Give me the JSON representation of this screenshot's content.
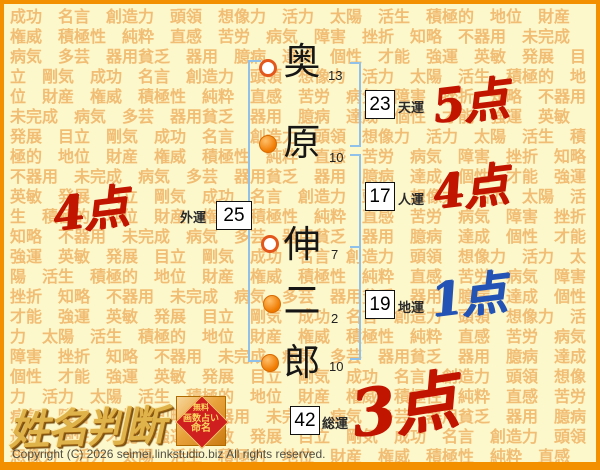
{
  "background": {
    "word_cycle": "成功　名言　創造力　頭領　想像力　活力　太陽　活生　積極的　地位　財産　権威　積極性　純粋　直感　苦労　病気　障害　挫折　知略　不器用　未完成　病気　多芸　器用貧乏　器用　臆病　達成　個性　才能　強運　英敏　発展　目立　剛気",
    "repeat": 9
  },
  "name": {
    "characters": [
      {
        "char": "奥",
        "strokes": "13",
        "marker": "open"
      },
      {
        "char": "原",
        "strokes": "10",
        "marker": "filled"
      },
      {
        "char": "伸",
        "strokes": "7",
        "marker": "open"
      },
      {
        "char": "二",
        "strokes": "2",
        "marker": "filled"
      },
      {
        "char": "郎",
        "strokes": "10",
        "marker": "filled"
      }
    ]
  },
  "fortunes": {
    "heaven": {
      "label": "天運",
      "value": "23",
      "score": "5点",
      "score_color": "#c21500"
    },
    "person": {
      "label": "人運",
      "value": "17",
      "score": "4点",
      "score_color": "#c21500"
    },
    "earth": {
      "label": "地運",
      "value": "19",
      "score": "1点",
      "score_color": "#2353b5"
    },
    "outer": {
      "label": "外運",
      "value": "25",
      "score": "4点",
      "score_color": "#c21500"
    },
    "total": {
      "label": "総運",
      "value": "42",
      "score": "3点",
      "score_color": "#c21500"
    }
  },
  "logo": {
    "title": "姓名判断",
    "badge": [
      "無料",
      "画数占い",
      "命名"
    ]
  },
  "footer": {
    "copyright": "Copyright (C) 2026 seimei.linkstudio.biz All rights reserved."
  },
  "colors": {
    "frame_border": "#f29000",
    "page_background": "#fdf8cc",
    "watermark_text": "#f1bd74",
    "bracket_blue": "#8fc1ea",
    "marker_orange": "#ef7a00",
    "score_red": "#c21500",
    "score_blue": "#2353b5",
    "logo_gold": "#e0b34a",
    "badge_red": "#cf1f1f"
  }
}
